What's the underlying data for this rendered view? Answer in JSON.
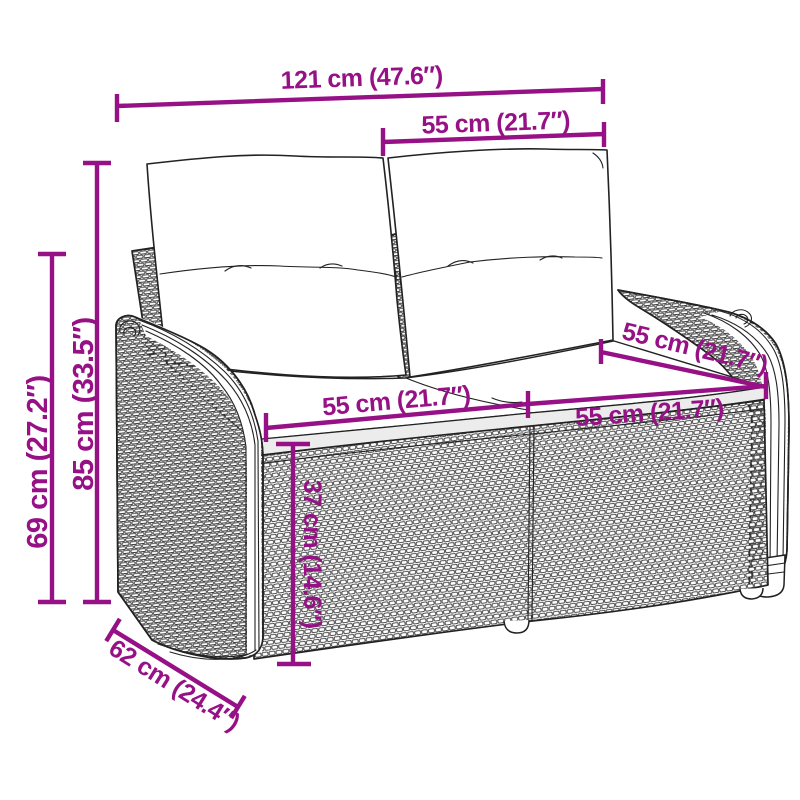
{
  "figure": {
    "type": "product-dimension-diagram",
    "subject": "rattan-garden-bench-with-cushions"
  },
  "colors": {
    "dimension": "#971186",
    "linework": "#222222",
    "background": "#ffffff",
    "shadow": "#ececec"
  },
  "dimensions": {
    "total_width": {
      "label": "121 cm (47.6″)"
    },
    "back_section_width": {
      "label": "55 cm (21.7″)"
    },
    "total_height": {
      "label": "85 cm (33.5″)"
    },
    "armrest_height": {
      "label": "69 cm (27.2″)"
    },
    "seat_left_width": {
      "label": "55 cm (21.7″)"
    },
    "seat_right_width": {
      "label": "55 cm (21.7″)"
    },
    "seat_depth": {
      "label": "55 cm (21.7″)"
    },
    "seat_height": {
      "label": "37 cm (14.6″)"
    },
    "total_depth": {
      "label": "62 cm (24.4″)"
    }
  }
}
